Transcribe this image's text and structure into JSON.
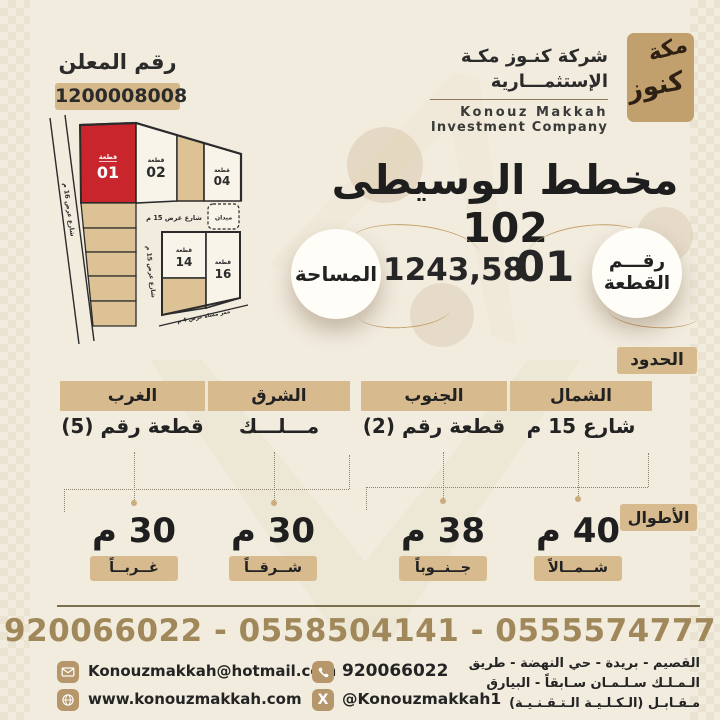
{
  "advertiser": {
    "label": "رقم المعلن",
    "number": "1200008008"
  },
  "logo": {
    "name_ar_line1": "شركة كنـوز مكـة",
    "name_ar_line2": "الإستثمـــارية",
    "name_en_line1": "Konouz Makkah",
    "name_en_line2": "Investment Company",
    "mark_word1": "مكة",
    "mark_word2": "كنوز"
  },
  "title": "مخطط الوسيطى 102",
  "plot_info": {
    "area_label": "المساحة",
    "area_value": "1243,58",
    "number_label_line1": "رقـــم",
    "number_label_line2": "القطعة",
    "number_value": "01"
  },
  "map": {
    "plot01": {
      "tag": "قطعة",
      "num": "01"
    },
    "plot02": {
      "tag": "قطعة",
      "num": "02"
    },
    "plot04": {
      "tag": "قطعة",
      "num": "04"
    },
    "plot14": {
      "tag": "قطعة",
      "num": "14"
    },
    "plot16": {
      "tag": "قطعة",
      "num": "16"
    },
    "plaza": "ميدان",
    "street_left": "شارع عرض 16 م",
    "street_top": "شارع عرض 15 م",
    "street_mid": "شارع عرض 15 م",
    "walkway": "ممر مشاة عرض 4 م"
  },
  "boundaries": {
    "section_label": "الحدود",
    "columns": [
      {
        "dir": "الشمال",
        "value": "شارع 15 م"
      },
      {
        "dir": "الجنوب",
        "value": "قطعة رقم (2)"
      },
      {
        "dir": "الشرق",
        "value": "مـــلـــك"
      },
      {
        "dir": "الغرب",
        "value": "قطعة رقم (5)"
      }
    ]
  },
  "lengths": {
    "section_label": "الأطوال",
    "items": [
      {
        "value": "40 م",
        "label": "شــمــالاً"
      },
      {
        "value": "38 م",
        "label": "جــنــوباً"
      },
      {
        "value": "30 م",
        "label": "شــرقــاً"
      },
      {
        "value": "30 م",
        "label": "غــربــاً"
      }
    ]
  },
  "contact": {
    "phones_line": "920066022 - 0558504141 - 0555574777",
    "email": "Konouzmakkah@hotmail.com",
    "website": "www.konouzmakkah.com",
    "phone": "920066022",
    "x_handle": "@Konouzmakkah1",
    "x_glyph": "X",
    "address_lines": [
      "القصيم - بريدة - حي النهضة - طريق",
      "الـمـلـك سـلـمـان سـابقاً - البيارق",
      "مـقـابـل (الـكـلـيـة الـتـقـنـيـة)"
    ]
  },
  "icons": {
    "email": "envelope-icon",
    "website": "globe-icon",
    "phone": "phone-icon",
    "x": "x-icon"
  },
  "colors": {
    "background": "#f2ecdf",
    "tan_badge": "#d7bb8e",
    "map_tan": "#dcc294",
    "plot_red": "#c8252c",
    "gold_text": "#a0885b",
    "dark_text": "#2b2b2b",
    "divider": "#7c6e4e"
  }
}
